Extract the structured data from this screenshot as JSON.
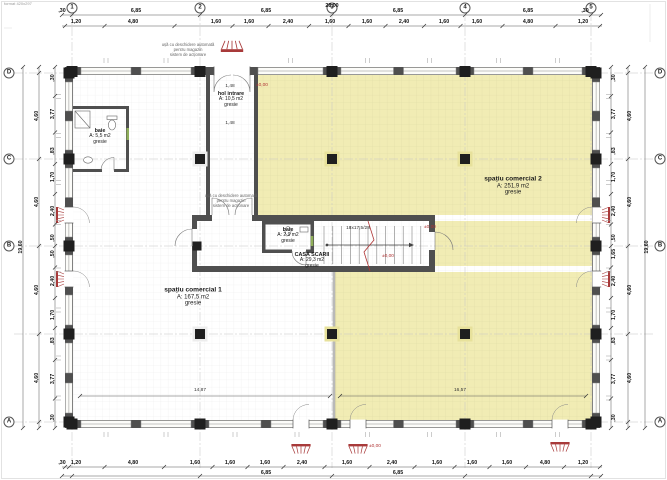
{
  "sheet": {
    "corner_note": "format 420x297"
  },
  "colors": {
    "commercial_fill": "#f1ecb4",
    "wall": "#4f4f4f",
    "annotation_red": "#b03535"
  },
  "grid": {
    "top_bubbles": [
      {
        "label": "1",
        "x": 72
      },
      {
        "label": "2",
        "x": 200
      },
      {
        "label": "3",
        "x": 332
      },
      {
        "label": "4",
        "x": 465
      },
      {
        "label": "5",
        "x": 591
      }
    ],
    "left_bubbles": [
      {
        "label": "D",
        "y": 73
      },
      {
        "label": "C",
        "y": 159
      },
      {
        "label": "B",
        "y": 246
      },
      {
        "label": "A",
        "y": 422
      }
    ],
    "right_bubbles": [
      {
        "label": "D",
        "y": 73
      },
      {
        "label": "C",
        "y": 159
      },
      {
        "label": "B",
        "y": 246
      },
      {
        "label": "A",
        "y": 422
      }
    ]
  },
  "dimensions": {
    "top_total": {
      "text": "28,00",
      "x": 332,
      "y": 6
    },
    "top_row1": [
      {
        "text": ",30",
        "x": 62,
        "y": 11
      },
      {
        "text": "6,85",
        "x": 136,
        "y": 11
      },
      {
        "text": "6,85",
        "x": 266,
        "y": 11
      },
      {
        "text": "6,85",
        "x": 398,
        "y": 11
      },
      {
        "text": "6,85",
        "x": 528,
        "y": 11
      },
      {
        "text": ",30",
        "x": 585,
        "y": 11
      }
    ],
    "top_row2": [
      {
        "text": "1,20",
        "x": 76,
        "y": 22
      },
      {
        "text": "4,80",
        "x": 133,
        "y": 22
      },
      {
        "text": "1,60",
        "x": 216,
        "y": 22
      },
      {
        "text": "1,60",
        "x": 249,
        "y": 22
      },
      {
        "text": "2,40",
        "x": 288,
        "y": 22
      },
      {
        "text": "1,60",
        "x": 330,
        "y": 22
      },
      {
        "text": "1,60",
        "x": 367,
        "y": 22
      },
      {
        "text": "2,40",
        "x": 404,
        "y": 22
      },
      {
        "text": "1,60",
        "x": 444,
        "y": 22
      },
      {
        "text": "1,60",
        "x": 477,
        "y": 22
      },
      {
        "text": "4,80",
        "x": 528,
        "y": 22
      },
      {
        "text": "1,20",
        "x": 583,
        "y": 22
      }
    ],
    "bottom_row1": [
      {
        "text": ",30",
        "x": 62,
        "y": 463
      },
      {
        "text": "1,20",
        "x": 76,
        "y": 463
      },
      {
        "text": "4,80",
        "x": 133,
        "y": 463
      },
      {
        "text": "1,60",
        "x": 195,
        "y": 463
      },
      {
        "text": "1,60",
        "x": 230,
        "y": 463
      },
      {
        "text": "1,60",
        "x": 265,
        "y": 463
      },
      {
        "text": "2,40",
        "x": 302,
        "y": 463
      },
      {
        "text": "1,60",
        "x": 347,
        "y": 463
      },
      {
        "text": "2,40",
        "x": 392,
        "y": 463
      },
      {
        "text": "1,60",
        "x": 437,
        "y": 463
      },
      {
        "text": "1,60",
        "x": 472,
        "y": 463
      },
      {
        "text": "1,60",
        "x": 507,
        "y": 463
      },
      {
        "text": "4,80",
        "x": 545,
        "y": 463
      },
      {
        "text": "1,20",
        "x": 583,
        "y": 463
      }
    ],
    "bottom_row2": [
      {
        "text": "6,85",
        "x": 266,
        "y": 473
      },
      {
        "text": "6,85",
        "x": 398,
        "y": 473
      }
    ],
    "left_total": {
      "text": "19,60",
      "x": 21,
      "y": 247
    },
    "left_outer": [
      {
        "text": "4,60",
        "y": 116
      },
      {
        "text": "4,60",
        "y": 202
      },
      {
        "text": "4,60",
        "y": 290
      },
      {
        "text": "4,60",
        "y": 378
      }
    ],
    "left_inner": [
      {
        "text": ",30",
        "y": 78
      },
      {
        "text": "3,77",
        "y": 114
      },
      {
        "text": ",83",
        "y": 151
      },
      {
        "text": "1,70",
        "y": 177
      },
      {
        "text": "2,40",
        "y": 211
      },
      {
        "text": ",50",
        "y": 238
      },
      {
        "text": ",50",
        "y": 254
      },
      {
        "text": "2,40",
        "y": 281
      },
      {
        "text": "1,70",
        "y": 315
      },
      {
        "text": ",83",
        "y": 341
      },
      {
        "text": "3,77",
        "y": 379
      },
      {
        "text": ",30",
        "y": 418
      }
    ],
    "right_total": {
      "text": "19,60",
      "x": 647,
      "y": 247
    },
    "right_outer": [
      {
        "text": "4,60",
        "y": 116
      },
      {
        "text": "4,60",
        "y": 202
      },
      {
        "text": "4,60",
        "y": 290
      },
      {
        "text": "4,60",
        "y": 378
      }
    ],
    "right_inner": [
      {
        "text": ",30",
        "y": 78
      },
      {
        "text": "3,77",
        "y": 114
      },
      {
        "text": ",83",
        "y": 151
      },
      {
        "text": "1,70",
        "y": 177
      },
      {
        "text": "2,40",
        "y": 211
      },
      {
        "text": ",50",
        "y": 238
      },
      {
        "text": "1,65",
        "y": 254
      },
      {
        "text": "2,40",
        "y": 281
      },
      {
        "text": "1,70",
        "y": 315
      },
      {
        "text": ",83",
        "y": 341
      },
      {
        "text": "3,77",
        "y": 379
      },
      {
        "text": ",30",
        "y": 418
      }
    ]
  },
  "rooms": [
    {
      "name": "spațiu comercial 1",
      "area": "A: 167,5 m2",
      "finish": "gresie",
      "x": 193,
      "y": 297,
      "style": "large"
    },
    {
      "name": "spațiu comercial 2",
      "area": "A: 251,9 m2",
      "finish": "gresie",
      "x": 513,
      "y": 186,
      "style": "large"
    },
    {
      "name": "hol intrare",
      "area": "A: 10,5 m2",
      "finish": "gresie",
      "x": 231,
      "y": 100,
      "style": "small"
    },
    {
      "name": "baie",
      "area": "A: 5,5 m2",
      "finish": "gresie",
      "x": 100,
      "y": 137,
      "style": "small"
    },
    {
      "name": "baie",
      "area": "A: 2,9 m2",
      "finish": "gresie",
      "x": 288,
      "y": 236,
      "style": "small"
    },
    {
      "name": "CASA SCARII",
      "area": "A: 29,3 m2",
      "finish": "gresie",
      "x": 312,
      "y": 261,
      "style": "small"
    }
  ],
  "annotations": [
    {
      "text": "ușă cu deschidere automată\npentru magazin\nsistem de acționare",
      "x": 188,
      "y": 50,
      "kind": "note"
    },
    {
      "text": "ușă cu deschidere automată\npentru magazin\nsistem de acționare",
      "x": 231,
      "y": 201,
      "kind": "note"
    },
    {
      "text": "±0,00",
      "x": 262,
      "y": 86,
      "kind": "red"
    },
    {
      "text": "±0,00",
      "x": 430,
      "y": 228,
      "kind": "red"
    },
    {
      "text": "±0,00",
      "x": 388,
      "y": 257,
      "kind": "red"
    },
    {
      "text": "±0,00",
      "x": 375,
      "y": 447,
      "kind": "red"
    },
    {
      "text": "18x17,5/28",
      "x": 358,
      "y": 229,
      "kind": "tiny"
    },
    {
      "text": "1,48",
      "x": 230,
      "y": 87,
      "kind": "tiny"
    },
    {
      "text": "1,48",
      "x": 230,
      "y": 124,
      "kind": "tiny"
    },
    {
      "text": "14,87",
      "x": 200,
      "y": 391,
      "kind": "tiny"
    },
    {
      "text": "16,57",
      "x": 460,
      "y": 391,
      "kind": "tiny"
    }
  ]
}
